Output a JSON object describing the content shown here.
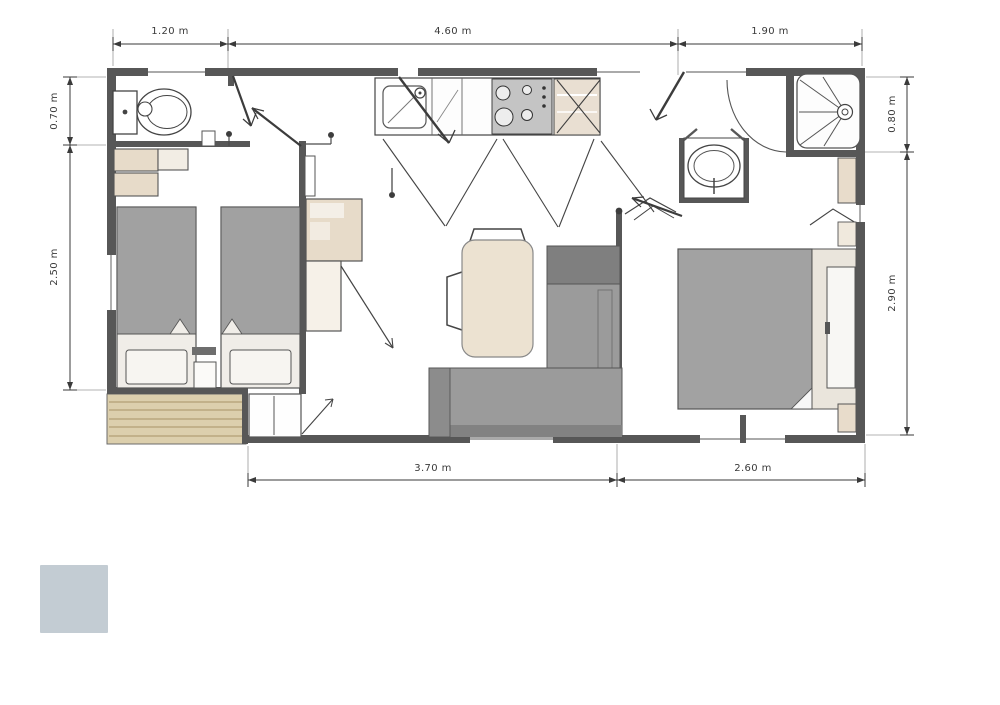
{
  "floor_plan": {
    "dimensions": {
      "top": [
        {
          "label": "1.20 m"
        },
        {
          "label": "4.60 m"
        },
        {
          "label": "1.90 m"
        }
      ],
      "left": [
        {
          "label": "0.70 m"
        },
        {
          "label": "2.50 m"
        }
      ],
      "right": [
        {
          "label": "0.80 m"
        },
        {
          "label": "2.90 m"
        }
      ],
      "bottom": [
        {
          "label": "3.70 m"
        },
        {
          "label": "2.60 m"
        }
      ]
    },
    "colors": {
      "wall": "#575757",
      "bed_mattress": "#a1a1a1",
      "sofa": "#9b9b9b",
      "sofa_backrest": "#7f7f7f",
      "furniture_wood": "#e7dbc9",
      "table_top": "#ece2d1",
      "deck_wood": "#dccfad",
      "stove": "#c4c4c4",
      "legend_swatch": "#c3ccd3"
    }
  },
  "legend": {
    "swatch_color": "#c3ccd3"
  }
}
